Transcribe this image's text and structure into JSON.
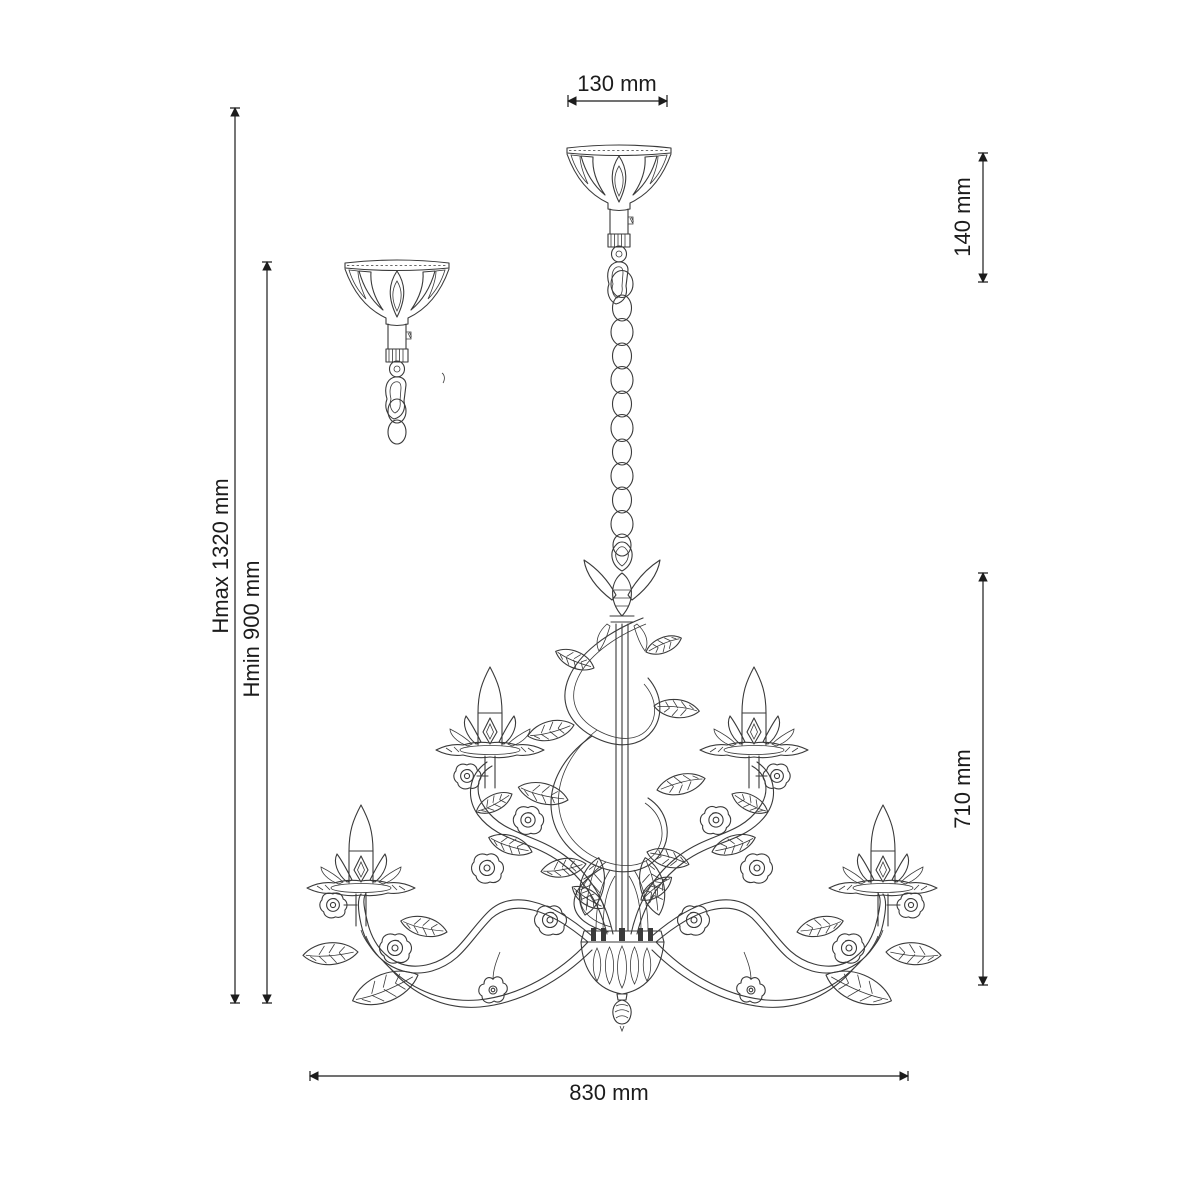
{
  "diagram": {
    "type": "product-dimension-drawing",
    "subject": "five-arm floral chandelier with ceiling canopy and chain",
    "unit": "mm"
  },
  "labels": {
    "canopy_width": "130 mm",
    "suspension_height": "140 mm",
    "height_max": "Hmax 1320 mm",
    "height_min": "Hmin 900 mm",
    "fixture_height": "710 mm",
    "fixture_width": "830 mm"
  },
  "colors": {
    "line": "#3a3a3a",
    "dimension": "#1c1c1c",
    "text": "#1c1c1c",
    "background": "#ffffff"
  }
}
